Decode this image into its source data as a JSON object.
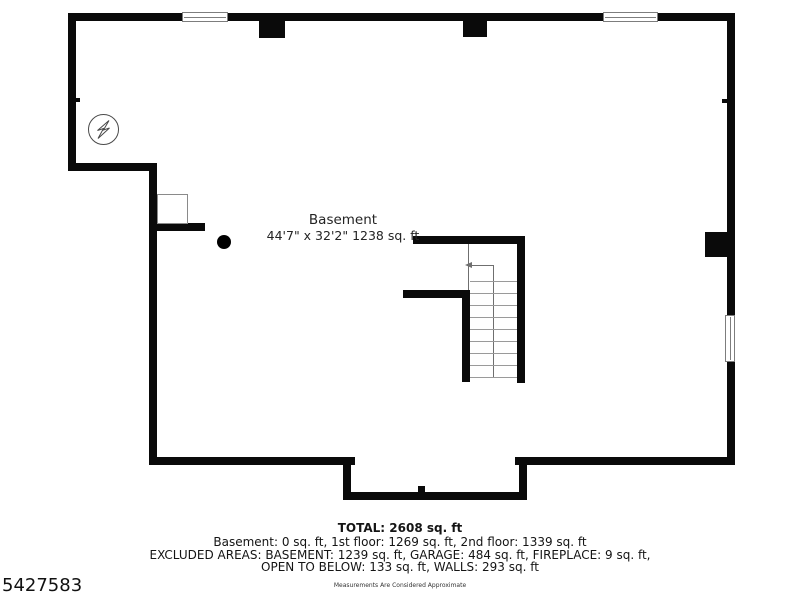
{
  "floorplan": {
    "room_label": "Basement",
    "room_dimensions": "44'7\" x 32'2\" 1238 sq. ft",
    "colors": {
      "wall": "#0a0a0a",
      "thin_line": "#6f6f6f",
      "tread_line": "#9a9a9a",
      "text": "#242424"
    },
    "icons": {
      "electrical": "electrical-symbol-icon",
      "column": "support-column-dot",
      "stair_arrow": "stair-direction-arrow"
    }
  },
  "footer": {
    "total": "TOTAL: 2608 sq. ft",
    "floors": "Basement: 0 sq. ft, 1st floor: 1269 sq. ft, 2nd floor: 1339 sq. ft",
    "excluded_line1": "EXCLUDED AREAS: BASEMENT: 1239 sq. ft, GARAGE: 484 sq. ft, FIREPLACE: 9 sq. ft,",
    "excluded_line2": "OPEN TO BELOW: 133 sq. ft, WALLS: 293 sq. ft",
    "disclaimer": "Measurements Are Considered Approximate"
  },
  "listing_id": "5427583"
}
